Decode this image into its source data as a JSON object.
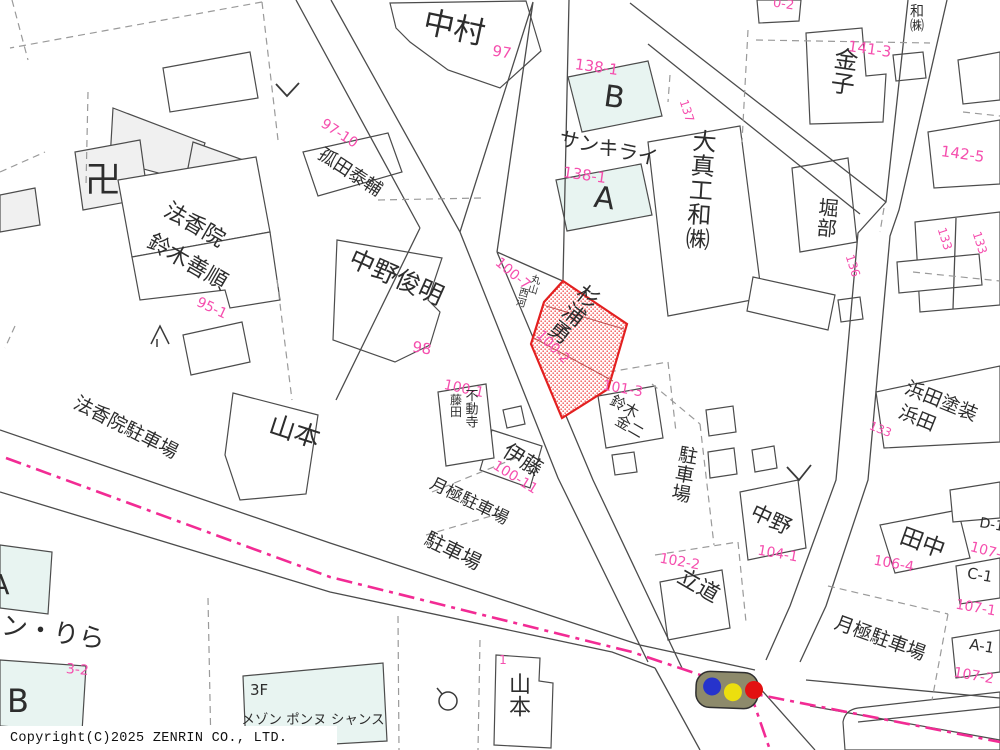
{
  "map_type": "zenrin-residential-map",
  "copyright": "Copyright(C)2025 ZENRIN CO., LTD.",
  "colors": {
    "label_pink": "#f54fae",
    "boundary_pink": "#f22b94",
    "highlight_red": "#e32020",
    "building_cyan": "#e8f4f1",
    "building_gray": "#f0f0f0",
    "line_gray": "#4c4c4c",
    "traffic_body": "#8d8a6b",
    "signal_blue": "#2633cc",
    "signal_yellow": "#ecdf0e",
    "signal_red": "#e31111"
  },
  "highlighted_parcel": {
    "owner": "杉浦勇",
    "parcel_number": "100-2",
    "style": "red-hatch"
  },
  "labels": {
    "nakamura": "中村",
    "no97": "97",
    "unitB": "B",
    "no138_1b": "138-1",
    "sankirai": "サンキライ",
    "unitA": "A",
    "no138_1a": "138-1",
    "no137": "137",
    "daishinkowa": "大真工和㈱",
    "kaneko": "金子",
    "no141_3": "141-3",
    "no0_2": "0-2",
    "wa_kabu": "和㈱",
    "horibe": "堀部",
    "no136": "136",
    "no142_5": "142-5",
    "no133a": "133",
    "no133b": "133",
    "manji": "卍",
    "hokoin": "法香院",
    "suzuki_zenjun": "鈴木善順",
    "no95_1": "95-1",
    "kodata_taisuke": "孤田泰輔",
    "no97_10": "97-10",
    "nakano_toshiaki": "中野俊明",
    "no98": "98",
    "no100_7": "100-7",
    "maruyama": "丸山",
    "nishikawa": "西河",
    "sugiura_isamu": "杉浦勇",
    "no100_2": "100-2",
    "no100_1": "100-1",
    "fudoji": "不動寺",
    "fujita": "藤田",
    "ito": "伊藤",
    "no100_11": "100-11",
    "tsukigime_parking1": "月極駐車場",
    "parking1": "駐車場",
    "no101_3": "101-3",
    "suzuki": "鈴木",
    "kinji": "金二",
    "parking_right": "駐車場",
    "nakano": "中野",
    "no104_1": "104-1",
    "no102_2": "102-2",
    "tatsumichi": "立道",
    "hamada_tosou": "浜田塗装",
    "hamada": "浜田",
    "no133c": "133",
    "tanaka": "田中",
    "no106_4": "106-4",
    "d1": "D-1",
    "c1": "C-1",
    "no107_1": "107-1",
    "a1": "A-1",
    "no107_2": "107-2",
    "no107_3": "107-3",
    "tsukigime_parking2": "月極駐車場",
    "hokoin_parking": "法香院駐車場",
    "yamamoto_left": "山本",
    "yamamoto_bottom": "山本",
    "no1": "1",
    "n_rira": "ン・りら",
    "no3_2": "3-2",
    "b_left": "B",
    "a_left": "A",
    "f3": "3F",
    "maison": "メゾン ポンヌ シャンス"
  }
}
